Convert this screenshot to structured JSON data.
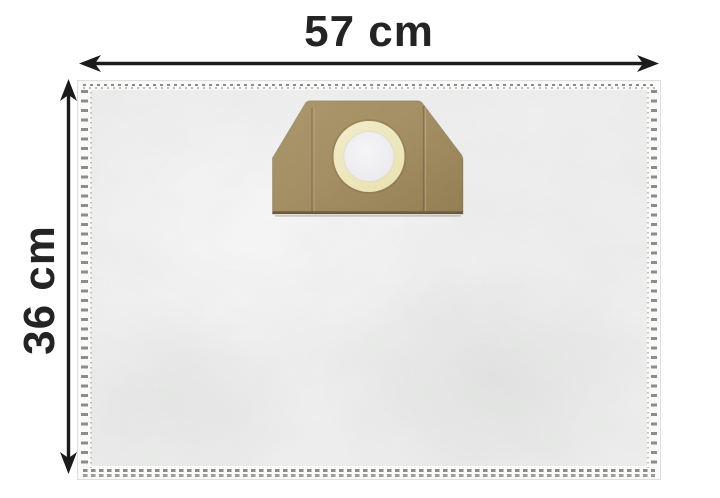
{
  "dimensions": {
    "width_label": "57 cm",
    "height_label": "36 cm"
  },
  "icons": {
    "width_arrow": "horizontal-double-headed-measurement-arrow",
    "height_arrow": "vertical-double-headed-measurement-arrow"
  },
  "colors": {
    "background": "#ffffff",
    "text": "#242424",
    "arrow": "#1b1b1b",
    "bag_fill": "#eeefee",
    "bag_seam": "#fafaf9",
    "stitch": "#8c8c8c",
    "stitch_light": "#b3b3b3",
    "cardboard": "#a68f63",
    "cardboard_light": "#b09a6f",
    "cardboard_dark": "#947d52",
    "cardboard_edge": "#6f5d40",
    "ring_cream": "#eae3b4",
    "ring_cream_light": "#f1ecca",
    "hole_white": "#f5f5f7",
    "hole_edge": "#e9e9ed"
  }
}
